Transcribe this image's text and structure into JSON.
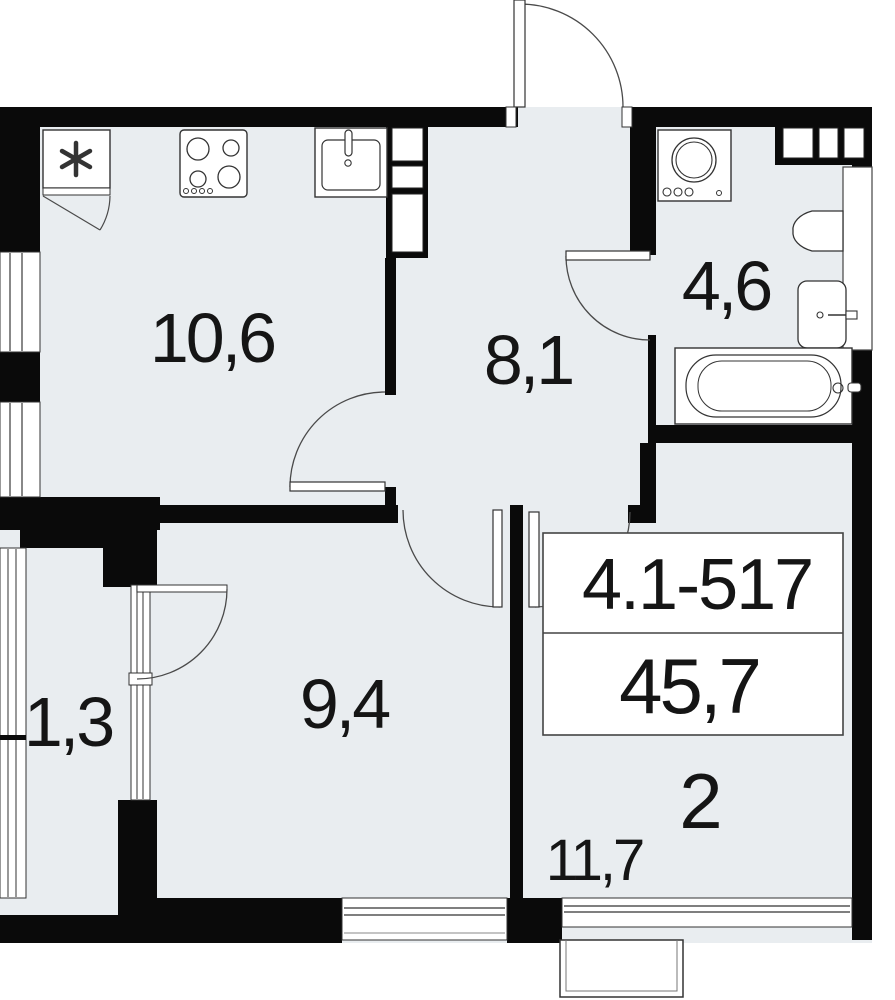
{
  "unit": {
    "number": "4.1-517",
    "total_area": "45,7",
    "rooms_count": "2"
  },
  "rooms": [
    {
      "name": "kitchen",
      "area": "10,6"
    },
    {
      "name": "hallway",
      "area": "8,1"
    },
    {
      "name": "bathroom",
      "area": "4,6"
    },
    {
      "name": "bedroom",
      "area": "9,4"
    },
    {
      "name": "balcony",
      "area": "1,3"
    },
    {
      "name": "living-room",
      "area": "11,7"
    }
  ],
  "fixtures": [
    "vent-box",
    "stove",
    "kitchen-sink",
    "washing-machine",
    "toilet",
    "wash-basin",
    "bathtub"
  ],
  "colors": {
    "floor": "#e9edf0",
    "wall": "#0a0a0a",
    "line": "#4a4a4a",
    "text": "#151515",
    "background": "#ffffff"
  }
}
